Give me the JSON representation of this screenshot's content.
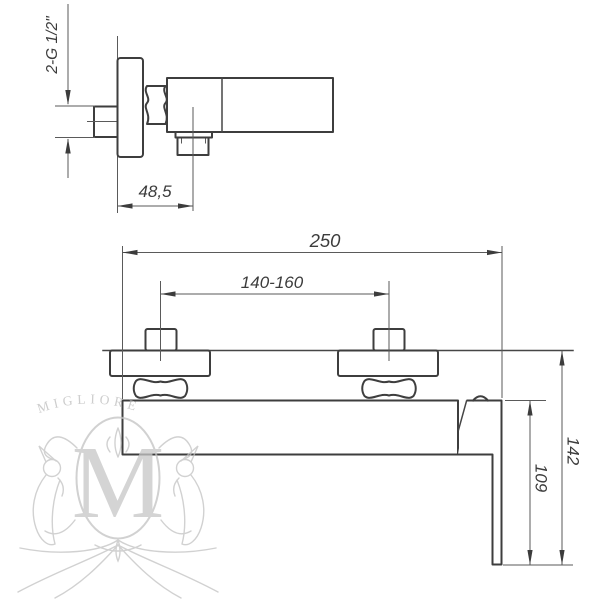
{
  "side_view": {
    "thread_label": "2-G 1/2\"",
    "wall_to_outlet_mm": "48,5"
  },
  "front_view": {
    "overall_length_mm": "250",
    "mounting_centers_mm": "140-160",
    "body_to_handle_end_mm": "109",
    "wall_to_handle_end_mm": "142"
  },
  "watermark": {
    "brand": "MIGLIORE",
    "monogram": "M"
  },
  "colors": {
    "outline": "#3e3e3e",
    "dimension_line": "#5a5a5a",
    "text": "#3c3c3c",
    "watermark": "#c2c2c2",
    "background": "#ffffff"
  }
}
